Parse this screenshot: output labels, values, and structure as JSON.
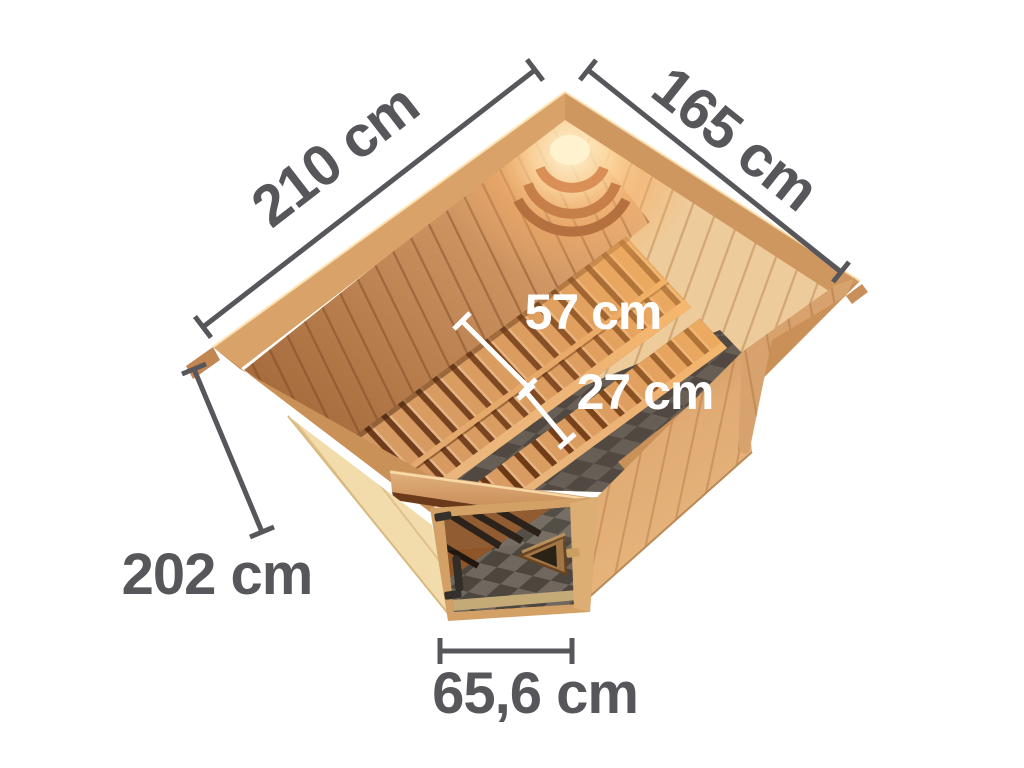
{
  "figure": {
    "description": "Top view dimension diagram of a wooden corner sauna with glass door, interior benches and sauna lamp",
    "background_color": "#ffffff",
    "units": "cm"
  },
  "dimensions": {
    "left_side_length": {
      "label": "210 cm"
    },
    "right_side_length": {
      "label": "165 cm"
    },
    "main_bench_depth": {
      "label": "57 cm"
    },
    "lower_bench_depth": {
      "label": "27 cm"
    },
    "wall_height": {
      "label": "202 cm"
    },
    "door_width": {
      "label": "65,6 cm"
    }
  },
  "colors": {
    "dimension_text_dark": "#57575b",
    "dimension_text_light": "#ffffff",
    "dimension_line_dark": "#57575b",
    "dimension_line_light": "#ffffff",
    "wood_pale_wall": "#f2dcab",
    "wood_exterior_wall": "#dfaa72",
    "wood_trim_band": "#c99057",
    "wood_interior_dark": "#9c6234",
    "wood_interior_light": "#eecb9a",
    "wood_bench_slat": "#d59a63",
    "bench_gap_dark": "#6b3a1c",
    "door_glass_dark": "#39322b",
    "floor_tile_light": "#8b8379",
    "floor_tile_dark": "#5a544d",
    "lamp_glow": "#ffd9a0"
  }
}
